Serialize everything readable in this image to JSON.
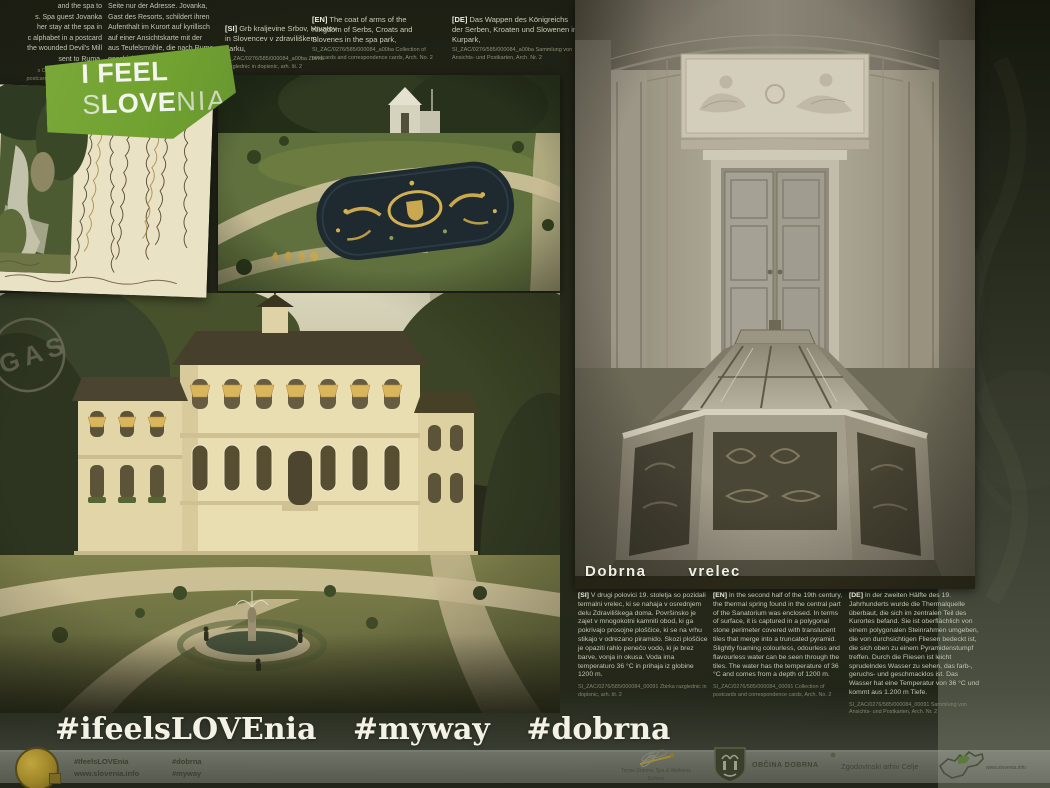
{
  "logo": {
    "line1": "I FEEL",
    "s": "S",
    "love": "LOVE",
    "nia": "NIA"
  },
  "top_fragments": {
    "en_lines": [
      "and the spa to",
      "s. Spa guest Jovanka",
      "her stay at the spa in",
      "c alphabet in a postcard",
      "the wounded Devil's Mill",
      "sent to Ruma,"
    ],
    "en_source_lines": [
      "s Obrenovac, Collection of",
      "postcards and correspondence",
      "cards, Arch. No. 2"
    ],
    "de_lines": [
      "Seite nur der Adresse. Jovanka,",
      "Gast des Resorts, schildert ihren",
      "Aufenthalt im Kurort auf kyrillisch",
      "auf einer Ansichtskarte mit der",
      "aus Teufelsmühle, die nach Ruma",
      "geschickt wurde."
    ]
  },
  "park_captions": {
    "si": {
      "tag": "[SI]",
      "text": "Grb kraljevine Srbov, Hrvatov in Slovencev v zdraviliškem parku,",
      "source": "SI_ZAC/0276/585/000084_a00ba Zbirka razglednic in dopisnic, arh. št. 2"
    },
    "en": {
      "tag": "[EN]",
      "text": "The coat of arms of the Kingdom of Serbs, Croats and Slovenes in the spa park,",
      "source": "SI_ZAC/0276/585/000084_a00ba Collection of postcards and correspondence cards, Arch. No. 2"
    },
    "de": {
      "tag": "[DE]",
      "text": "Das Wappen des Königreichs der Serben, Kroaten und Slowenen im Kurpark,",
      "source": "SI_ZAC/0276/585/000084_a00ba Sammlung von Ansichts- und Postkarten, Arch. Nr. 2"
    }
  },
  "photo_label": {
    "word1": "Dobrna",
    "word2": "vrelec"
  },
  "spring_texts": {
    "si": {
      "tag": "[SI]",
      "text": "V drugi polovici 19. stoletja so pozidali termalni vrelec, ki se nahaja v osrednjem delu Zdraviliškega doma. Površinsko je zajet v mnogokotni kamniti obod, ki ga pokrivajo prosojne ploščice, ki se na vrhu stikajo v odrezano piramido. Skozi ploščice je opaziti rahlo penečo vodo, ki je brez barve, vonja in okusa. Voda ima temperaturo 36 °C in prihaja iz globine 1200 m.",
      "source": "SI_ZAC/0276/585/000084_00091 Zbirka razglednic in dopisnic, arh. št. 2"
    },
    "en": {
      "tag": "[EN]",
      "text": "In the second half of the 19th century, the thermal spring found in the central part of the Sanatorium was enclosed. In terms of surface, it is captured in a polygonal stone perimeter covered with translucent tiles that merge into a truncated pyramid. Slightly foaming colourless, odourless and flavourless water can be seen through the tiles. The water has the temperature of 36 °C and comes from a depth of 1200 m.",
      "source": "SI_ZAC/0276/585/000084_00091 Collection of postcards and correspondence cards, Arch. No. 2"
    },
    "de": {
      "tag": "[DE]",
      "text": "In der zweiten Hälfte des 19. Jahrhunderts wurde die Thermalquelle überbaut, die sich im zentralen Teil des Kurortes befand. Sie ist oberflächlich von einem polygonalen Steinrahmen umgeben, die von durchsichtigen Fliesen bedeckt ist, die sich oben zu einem Pyramidenstumpf treffen. Durch die Fliesen ist leicht sprudelndes Wasser zu sehen, das farb-, geruchs- und geschmacklos ist. Das Wasser hat eine Temperatur von 36 °C und kommt aus 1.200 m Tiefe.",
      "source": "SI_ZAC/0276/585/000084_00091 Sammlung von Ansichts- und Postkarten, Arch. Nr. 2"
    }
  },
  "fountain_captions": {
    "edge_lines": [
      "ds painted",
      "o Ruma,"
    ],
    "edge_source": "AC/0276",
    "en": {
      "tag": "[EN]",
      "text": "Spa guests seeking refreshment by the fountain.",
      "source": "SI_ZAC/0276/585/000084_a0086 Collection of postcards and correspondence cards, Arch. No. 2"
    },
    "de": {
      "tag": "[DE]",
      "text": "Die Gäste des Kurortes erfrischten sich gerne am Brunnen.",
      "source": "SI_ZAC/0276/585/000084_a0086 Sammlung von Ansichts- und Postkarten, Arch. Nr. 2"
    }
  },
  "hashtags": [
    "#ifeelsLOVEnia",
    "#myway",
    "#dobrna"
  ],
  "footer": {
    "col1": [
      "#IfeelsLOVEnia",
      "www.slovenia.info"
    ],
    "col2": [
      "#dobrna",
      "#myway"
    ],
    "terme_caption": [
      "Terme Dobrna, Spa & Wellness",
      "Dobrna"
    ],
    "obcina_label": "OBČINA DOBRNA",
    "arhiv_label": "Zgodovinski arhiv Celje",
    "map_label": "www.slovenia.info"
  },
  "colors": {
    "logo_green": "#76a337",
    "awning_gold": "#d7b257",
    "footer_bar": "#999e92"
  }
}
